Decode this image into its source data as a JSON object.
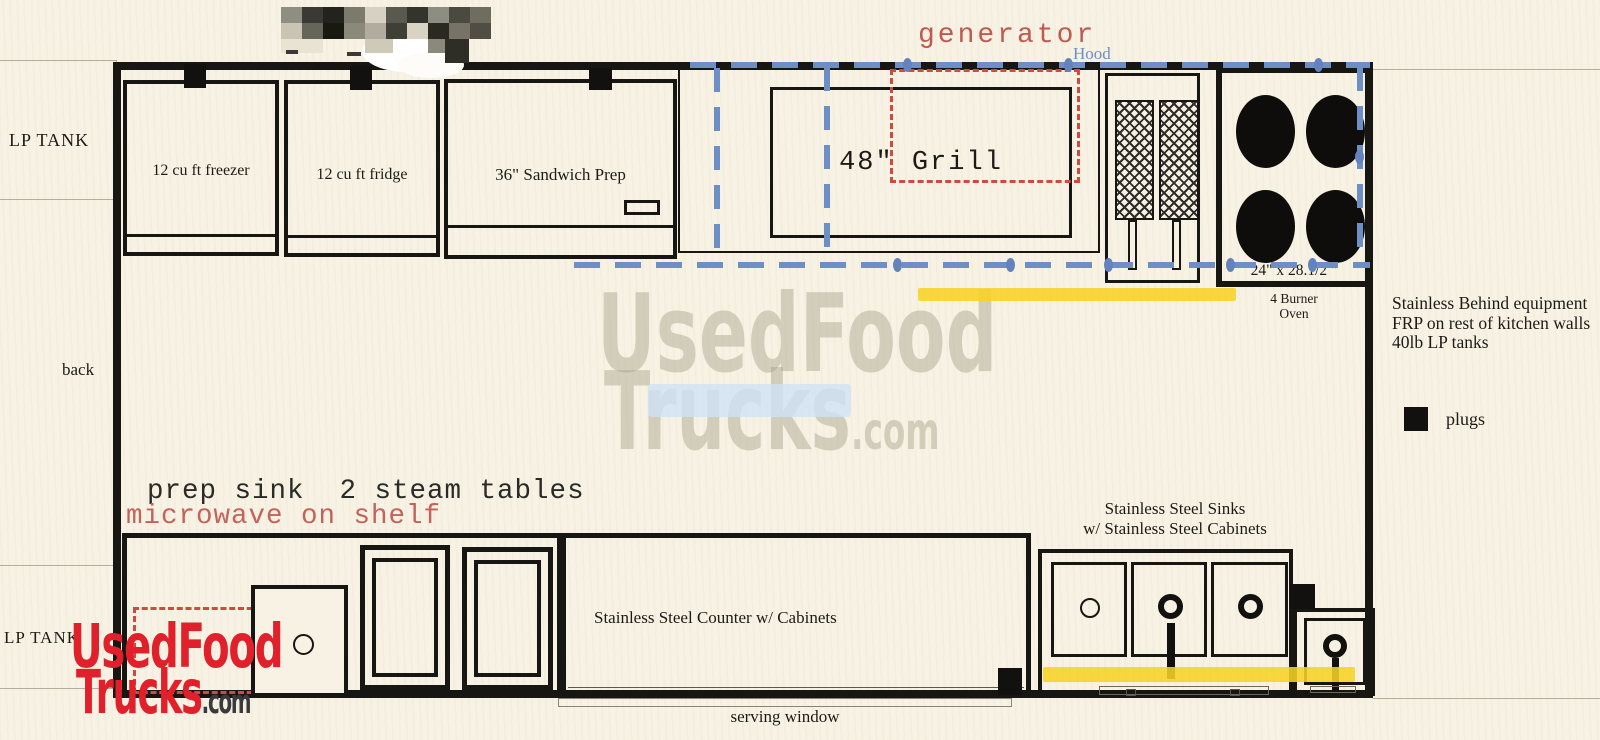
{
  "outside": {
    "lp_tank_top": "LP TANK",
    "back": "back",
    "lp_tank_bottom": "LP TANK"
  },
  "annotations": {
    "generator": "generator",
    "hood": "Hood",
    "prep_note": "prep sink  2 steam tables",
    "microwave_note": "microwave on shelf",
    "notes": [
      "Stainless Behind equipment",
      "FRP on rest of kitchen walls",
      "40lb LP tanks"
    ],
    "plugs_legend": "plugs"
  },
  "equipment": {
    "freezer": "12 cu ft freezer",
    "fridge": "12 cu ft fridge",
    "sandwich_prep": "36\" Sandwich Prep",
    "grill": "48\" Grill",
    "oven_dims": "24\" x 28.1/2 \"",
    "oven_caption_line1": "4 Burner",
    "oven_caption_line2": "Oven",
    "sinks_line1": "Stainless Steel Sinks",
    "sinks_line2": "w/ Stainless Steel Cabinets",
    "counter": "Stainless Steel Counter w/ Cabinets",
    "serving_window": "serving window"
  },
  "watermark": {
    "center_line1": "UsedFood",
    "center_line2": "Trucks",
    "center_suffix": ".com",
    "bottom_line1": "UsedFood",
    "bottom_line2": "Trucks",
    "bottom_suffix": ".com"
  },
  "colors": {
    "paper": "#f7f2e3",
    "line_black": "#171613",
    "hood_blue": "#6d8fc6",
    "dashed_red": "#d04a42",
    "annotation_red": "#c05a50",
    "highlight_yellow": "#f7d326",
    "watermark_red": "#e0202a",
    "watermark_gray": "#a39a82"
  }
}
